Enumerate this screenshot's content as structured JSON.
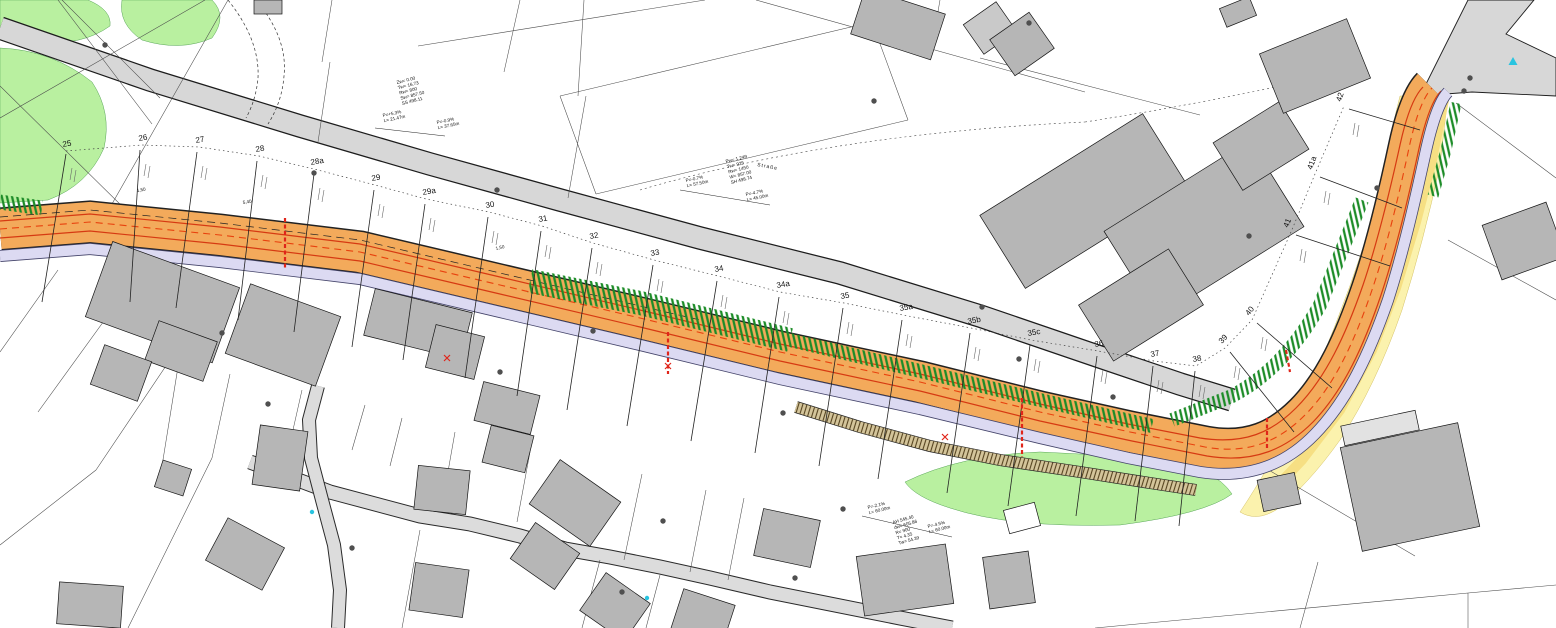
{
  "plan": {
    "type": "road-construction-site-plan",
    "stations": [
      {
        "label": "25",
        "x": 63,
        "y": 147,
        "rot": -10,
        "line": [
          66,
          154,
          42,
          302
        ]
      },
      {
        "label": "26",
        "x": 139,
        "y": 141,
        "rot": -10,
        "line": [
          140,
          150,
          130,
          302
        ]
      },
      {
        "label": "27",
        "x": 196,
        "y": 143,
        "rot": -10,
        "line": [
          197,
          152,
          176,
          308
        ]
      },
      {
        "label": "28",
        "x": 256,
        "y": 152,
        "rot": -10,
        "line": [
          257,
          161,
          238,
          320
        ]
      },
      {
        "label": "28a",
        "x": 311,
        "y": 165,
        "rot": -10,
        "line": [
          314,
          174,
          294,
          332
        ]
      },
      {
        "label": "29",
        "x": 372,
        "y": 181,
        "rot": -10,
        "line": [
          374,
          190,
          352,
          347
        ]
      },
      {
        "label": "29a",
        "x": 423,
        "y": 195,
        "rot": -10,
        "line": [
          425,
          204,
          403,
          360
        ]
      },
      {
        "label": "30",
        "x": 486,
        "y": 208,
        "rot": -10,
        "line": [
          488,
          217,
          465,
          378
        ]
      },
      {
        "label": "31",
        "x": 539,
        "y": 222,
        "rot": -10,
        "line": [
          541,
          231,
          517,
          396
        ]
      },
      {
        "label": "32",
        "x": 590,
        "y": 239,
        "rot": -10,
        "line": [
          592,
          248,
          567,
          410
        ]
      },
      {
        "label": "33",
        "x": 651,
        "y": 256,
        "rot": -10,
        "line": [
          653,
          265,
          627,
          426
        ]
      },
      {
        "label": "34",
        "x": 715,
        "y": 272,
        "rot": -10,
        "line": [
          717,
          281,
          691,
          441
        ]
      },
      {
        "label": "34a",
        "x": 777,
        "y": 288,
        "rot": -10,
        "line": [
          779,
          297,
          755,
          453
        ]
      },
      {
        "label": "35",
        "x": 841,
        "y": 299,
        "rot": -10,
        "line": [
          843,
          308,
          819,
          466
        ]
      },
      {
        "label": "35a",
        "x": 900,
        "y": 311,
        "rot": -10,
        "line": [
          902,
          320,
          878,
          479
        ]
      },
      {
        "label": "35b",
        "x": 968,
        "y": 324,
        "rot": -10,
        "line": [
          970,
          333,
          947,
          493
        ]
      },
      {
        "label": "35c",
        "x": 1028,
        "y": 336,
        "rot": -10,
        "line": [
          1030,
          345,
          1008,
          506
        ]
      },
      {
        "label": "36",
        "x": 1095,
        "y": 347,
        "rot": -10,
        "line": [
          1097,
          356,
          1076,
          516
        ]
      },
      {
        "label": "37",
        "x": 1151,
        "y": 357,
        "rot": -10,
        "line": [
          1153,
          366,
          1135,
          521
        ]
      },
      {
        "label": "38",
        "x": 1193,
        "y": 362,
        "rot": -10,
        "line": [
          1195,
          371,
          1179,
          526
        ]
      },
      {
        "label": "39",
        "x": 1222,
        "y": 344,
        "rot": -48,
        "line": [
          1230,
          352,
          1294,
          432
        ]
      },
      {
        "label": "40",
        "x": 1249,
        "y": 316,
        "rot": -52,
        "line": [
          1257,
          323,
          1332,
          388
        ]
      },
      {
        "label": "41",
        "x": 1288,
        "y": 228,
        "rot": -68,
        "line": [
          1296,
          235,
          1390,
          266
        ]
      },
      {
        "label": "41a",
        "x": 1312,
        "y": 170,
        "rot": -70,
        "line": [
          1320,
          177,
          1402,
          208
        ]
      },
      {
        "label": "42",
        "x": 1341,
        "y": 102,
        "rot": -72,
        "line": [
          1349,
          109,
          1420,
          130
        ]
      }
    ],
    "annotation_blocks": [
      {
        "x": 397,
        "y": 84,
        "rot": -14,
        "lines": [
          "Zw= 0.00",
          "Tw= 16.73",
          "Rw= 800",
          "Sw= 857.50",
          "SS 498.11"
        ]
      },
      {
        "x": 383,
        "y": 117,
        "rot": -12,
        "lines": [
          "P=+5.3%",
          "L= 21.47m"
        ]
      },
      {
        "x": 437,
        "y": 124,
        "rot": -12,
        "lines": [
          "P=-0.9%",
          "L= 37.65m"
        ]
      },
      {
        "x": 726,
        "y": 163,
        "rot": -14,
        "lines": [
          "Pw= 1.249",
          "Tw= 925",
          "Rw= 1450",
          "W= 857.00",
          "SH 498.74"
        ]
      },
      {
        "x": 686,
        "y": 182,
        "rot": -12,
        "lines": [
          "P=-0.7%",
          "L= 57.50m"
        ]
      },
      {
        "x": 746,
        "y": 196,
        "rot": -12,
        "lines": [
          "P=-4.7%",
          "L= 45.00m"
        ]
      },
      {
        "x": 893,
        "y": 524,
        "rot": -16,
        "lines": [
          "AH 545.40",
          "dw= 605.86",
          "R= 900",
          "T= 4.35",
          "Tw= 54.39"
        ]
      },
      {
        "x": 868,
        "y": 509,
        "rot": -14,
        "lines": [
          "P=-2.1%",
          "L= 60.00m"
        ]
      },
      {
        "x": 928,
        "y": 528,
        "rot": -14,
        "lines": [
          "P=-4.5%",
          "L= 60.00m"
        ]
      }
    ],
    "street_label": {
      "text": "Straße",
      "x": 757,
      "y": 166,
      "rot": 11
    },
    "width_labels": [
      {
        "text": "1,50",
        "x": 137,
        "y": 192,
        "rot": -9
      },
      {
        "text": "5,40",
        "x": 243,
        "y": 204,
        "rot": -9
      },
      {
        "text": "1,50",
        "x": 496,
        "y": 250,
        "rot": -13
      }
    ],
    "red_bars": [
      [
        285,
        218,
        285,
        268
      ],
      [
        668,
        332,
        668,
        374
      ],
      [
        1022,
        398,
        1022,
        457
      ],
      [
        1267,
        418,
        1267,
        448
      ],
      [
        1286,
        350,
        1290,
        372
      ]
    ],
    "red_points": [
      [
        668,
        366
      ],
      [
        945,
        437
      ],
      [
        447,
        358
      ]
    ],
    "cyan_marks": [
      {
        "x": 1513,
        "y": 62,
        "shape": "triangle"
      },
      {
        "x": 647,
        "y": 598,
        "shape": "dot"
      },
      {
        "x": 312,
        "y": 512,
        "shape": "dot"
      }
    ],
    "boundary_dots": [
      [
        105,
        45
      ],
      [
        314,
        173
      ],
      [
        497,
        190
      ],
      [
        593,
        331
      ],
      [
        500,
        372
      ],
      [
        222,
        333
      ],
      [
        268,
        404
      ],
      [
        783,
        413
      ],
      [
        795,
        578
      ],
      [
        843,
        509
      ],
      [
        982,
        307
      ],
      [
        1019,
        359
      ],
      [
        1113,
        397
      ],
      [
        663,
        521
      ],
      [
        874,
        101
      ],
      [
        1029,
        23
      ],
      [
        1249,
        236
      ],
      [
        1377,
        188
      ],
      [
        1470,
        78
      ],
      [
        1464,
        91
      ],
      [
        622,
        592
      ],
      [
        352,
        548
      ]
    ],
    "colors": {
      "new_road": "#f3aa5b",
      "existing_road": "#d7d7d7",
      "sidewalk": "#dcdaf2",
      "green_area": "#b9f0a0",
      "embankment_hatch": "#1d8c28",
      "acquisition_area": "#fbf2ad",
      "marking_red": "#d63a12",
      "building": "#b6b6b6"
    }
  }
}
